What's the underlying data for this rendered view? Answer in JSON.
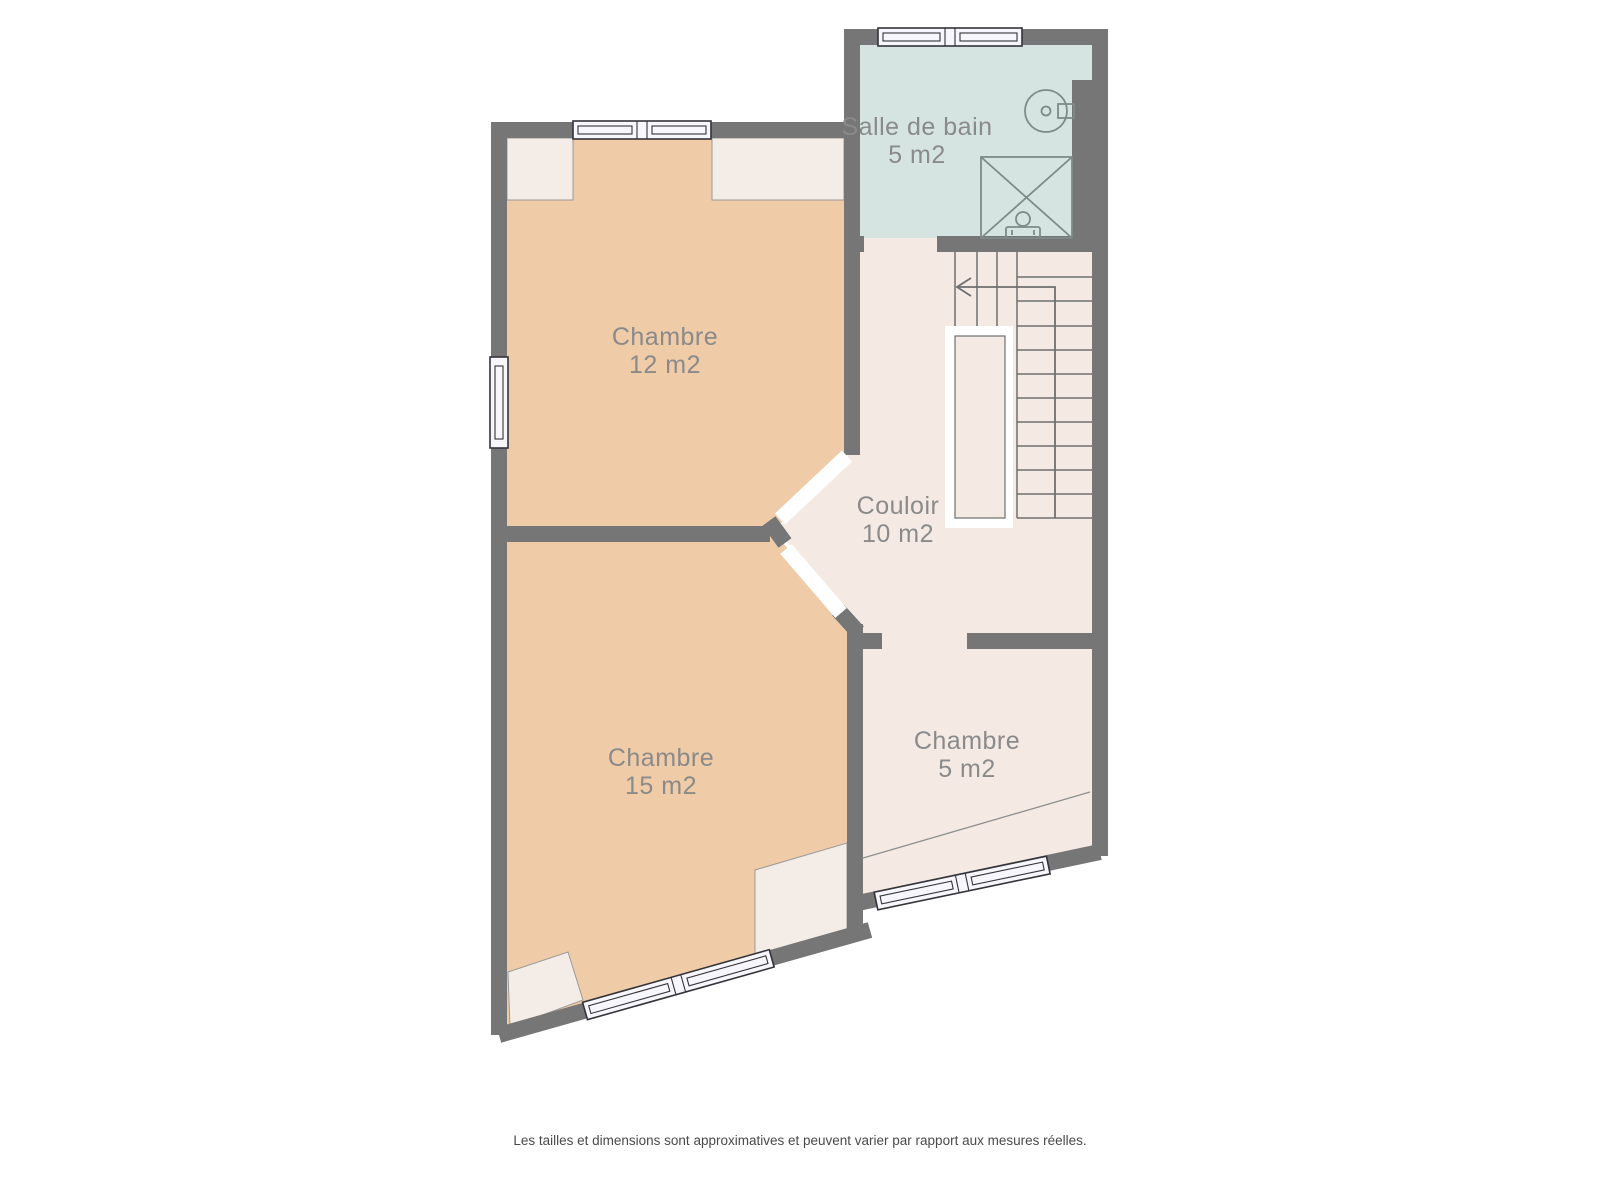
{
  "page": {
    "background": "#ffffff",
    "type": "floor-plan"
  },
  "rooms": [
    {
      "id": "chambre-12",
      "name": "Chambre",
      "area": "12 m2"
    },
    {
      "id": "salle-de-bain",
      "name": "Salle de bain",
      "area": "5 m2"
    },
    {
      "id": "couloir",
      "name": "Couloir",
      "area": "10 m2"
    },
    {
      "id": "chambre-15",
      "name": "Chambre",
      "area": "15 m2"
    },
    {
      "id": "chambre-5",
      "name": "Chambre",
      "area": "5 m2"
    }
  ],
  "fixtures": [
    "sink",
    "shower",
    "toilet",
    "staircase",
    "stair-direction-arrow"
  ],
  "windows": {
    "count": 5,
    "locations": [
      "chambre-12 top",
      "chambre-12 left",
      "salle-de-bain top",
      "chambre-15 bottom slanted",
      "chambre-5 bottom slanted"
    ]
  },
  "footer": {
    "disclaimer": "Les tailles et dimensions sont approximatives et peuvent varier par rapport aux mesures réelles."
  },
  "colors": {
    "wall": "#767676",
    "floor_bedroom": "#f0cba7",
    "floor_hall": "#f4eae3",
    "floor_bath": "#d6e4e1",
    "ceiling_patch": "#f4ede7",
    "patch_border": "#9a9a9a",
    "window_fill": "#f6f6fc",
    "window_border": "#33333a",
    "stair_line": "#6f6f6f",
    "ceiling_line": "#8f8f8f",
    "fixture_line": "#7d8a88",
    "label": "#8a8a8a",
    "footer": "#4a4a4a"
  }
}
